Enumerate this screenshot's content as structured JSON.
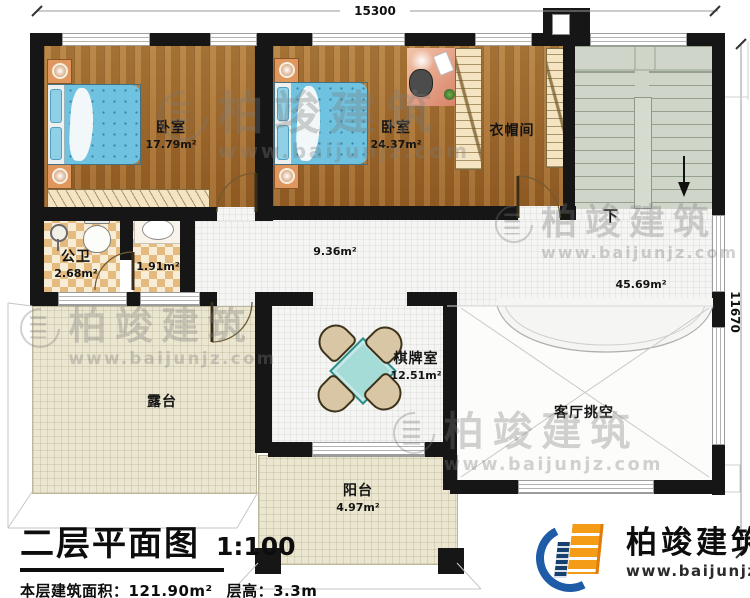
{
  "dimensions": {
    "top": "15300",
    "right": "11670"
  },
  "rooms": [
    {
      "name": "卧室",
      "area": "17.79m²"
    },
    {
      "name": "卧室",
      "area": "24.37m²"
    },
    {
      "name": "衣帽间",
      "area": ""
    },
    {
      "name": "公卫",
      "area": "2.68m²"
    },
    {
      "name": "",
      "area": "1.91m²"
    },
    {
      "name": "",
      "area": "9.36m²"
    },
    {
      "name": "",
      "area": "45.69m²"
    },
    {
      "name": "露台",
      "area": ""
    },
    {
      "name": "棋牌室",
      "area": "12.51m²"
    },
    {
      "name": "客厅挑空",
      "area": ""
    },
    {
      "name": "阳台",
      "area": "4.97m²"
    }
  ],
  "stairs": {
    "down_label": "下"
  },
  "title_block": {
    "title": "二层平面图",
    "scale": "1:100",
    "area_label": "本层建筑面积：",
    "area_value": "121.90m²",
    "floor_height_label": "层高：",
    "floor_height_value": "3.3m"
  },
  "brand": {
    "name": "柏竣建筑",
    "url": "www.baijunjz.com"
  },
  "colors": {
    "wall": "#161616",
    "wood_floor": "#a5732f",
    "tile_floor": "#f5f5f3",
    "terrace_floor": "#ebe6d0",
    "stairs_floor": "#cfd5c9",
    "bed": "#6fc3e0",
    "table": "#a5dcd8",
    "logo_blue": "#1e5ca8",
    "logo_orange": "#f49c18"
  }
}
